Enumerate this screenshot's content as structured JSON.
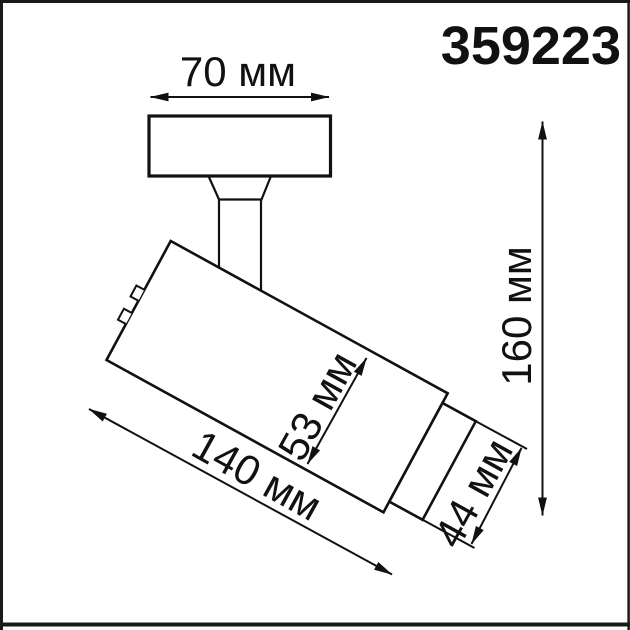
{
  "page": {
    "background": "#ffffff",
    "frame_color": "#1a1a1a"
  },
  "header": {
    "article_number": "359223"
  },
  "diagram": {
    "line_color": "#111111",
    "labels": {
      "base_width": "70 мм",
      "overall_height": "160 мм",
      "body_diameter": "53 мм",
      "body_length": "140 мм",
      "head_diameter": "44 мм"
    }
  }
}
